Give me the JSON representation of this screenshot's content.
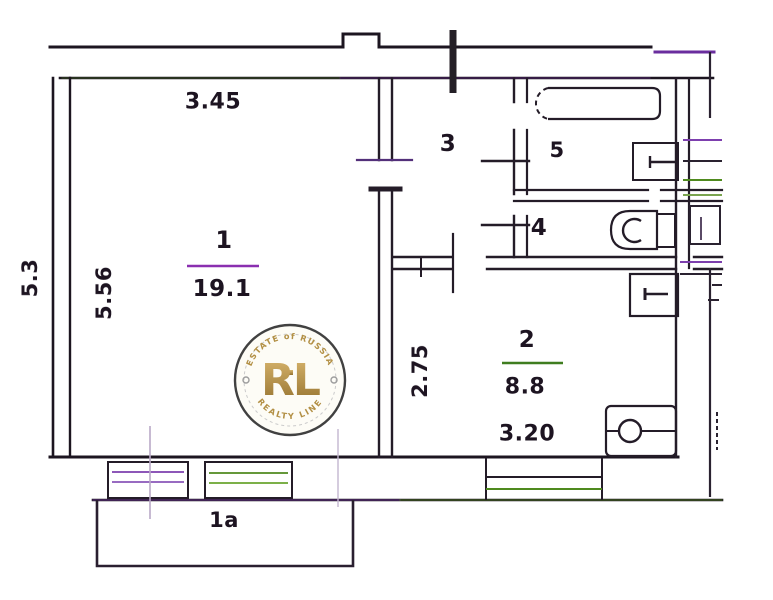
{
  "plan": {
    "rooms": [
      {
        "id": "room-1",
        "number": "1",
        "area": "19.1",
        "width_dim": "3.45",
        "height_dim": "5.56"
      },
      {
        "id": "room-2",
        "number": "2",
        "area": "8.8",
        "width_dim": "3.20",
        "height_dim": "2.75"
      },
      {
        "id": "room-3",
        "number": "3"
      },
      {
        "id": "room-4",
        "number": "4"
      },
      {
        "id": "room-5",
        "number": "5"
      }
    ],
    "balcony_label": "1а",
    "left_edge_dim": "5.3"
  },
  "watermark": {
    "top_text": "ESTATE of RUSSIA",
    "initials": "RL",
    "bottom_text": "REALTY LINE"
  },
  "colors": {
    "wall": "#1c1520",
    "accent_purple": "#7d2fa8",
    "accent_green": "#4f8a1e",
    "gold": "#b08c3e",
    "badge_border": "#3a3a3a"
  }
}
